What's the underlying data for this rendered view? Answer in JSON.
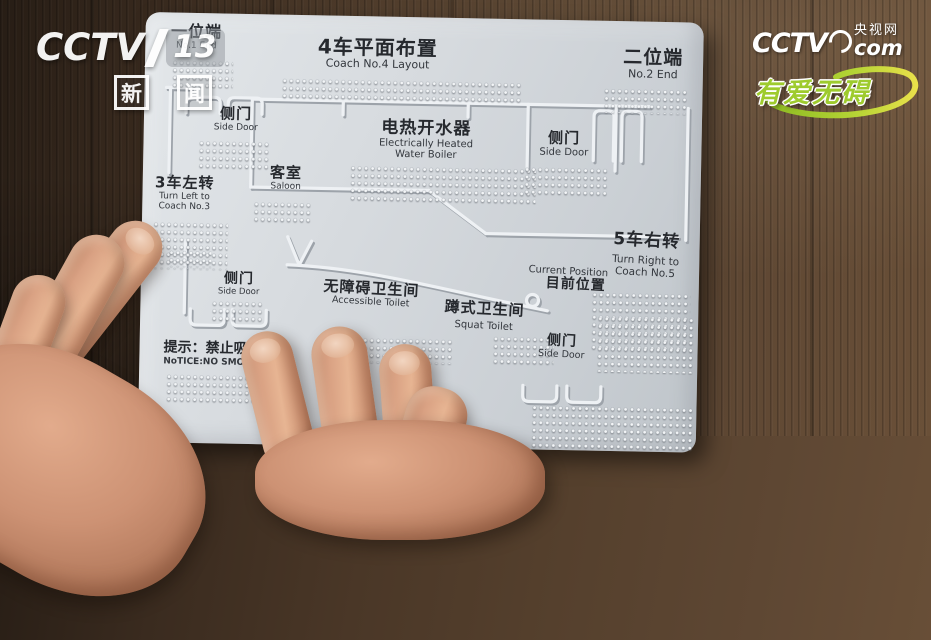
{
  "colors": {
    "wood": "#4a3727",
    "panel": "#d5d9dd",
    "panel_text": "#26292e",
    "brand_green": "#9ecb2d",
    "skin": "#d9a183"
  },
  "watermark_left": {
    "brand": "CCTV",
    "channel_number": "13",
    "channel_name_1": "新",
    "channel_name_2": "闻"
  },
  "watermark_right": {
    "brand": "CCTV",
    "site_zh": "央视网",
    "domain": "com",
    "slogan": "有爱无碍"
  },
  "panel": {
    "title_zh": "4车平面布置",
    "title_en": "Coach No.4 Layout",
    "end1_zh": "一位端",
    "end1_en": "No.1 End",
    "end2_zh": "二位端",
    "end2_en": "No.2 End",
    "side_door_zh": "侧门",
    "side_door_en": "Side Door",
    "saloon_zh": "客室",
    "saloon_en": "Saloon",
    "boiler_zh": "电热开水器",
    "boiler_en_line1": "Electrically Heated",
    "boiler_en_line2": "Water Boiler",
    "turn_left_zh": "3车左转",
    "turn_left_en_line1": "Turn Left to",
    "turn_left_en_line2": "Coach No.3",
    "turn_right_zh": "5车右转",
    "turn_right_en_line1": "Turn Right to",
    "turn_right_en_line2": "Coach No.5",
    "accessible_toilet_zh": "无障碍卫生间",
    "accessible_toilet_en": "Accessible Toilet",
    "squat_toilet_zh": "蹲式卫生间",
    "squat_toilet_en": "Squat Toilet",
    "current_position_en": "Current Position",
    "current_position_zh": "目前位置",
    "notice_zh": "提示：禁止吸烟！",
    "notice_en": "NoTICE:NO SMOKING!"
  }
}
